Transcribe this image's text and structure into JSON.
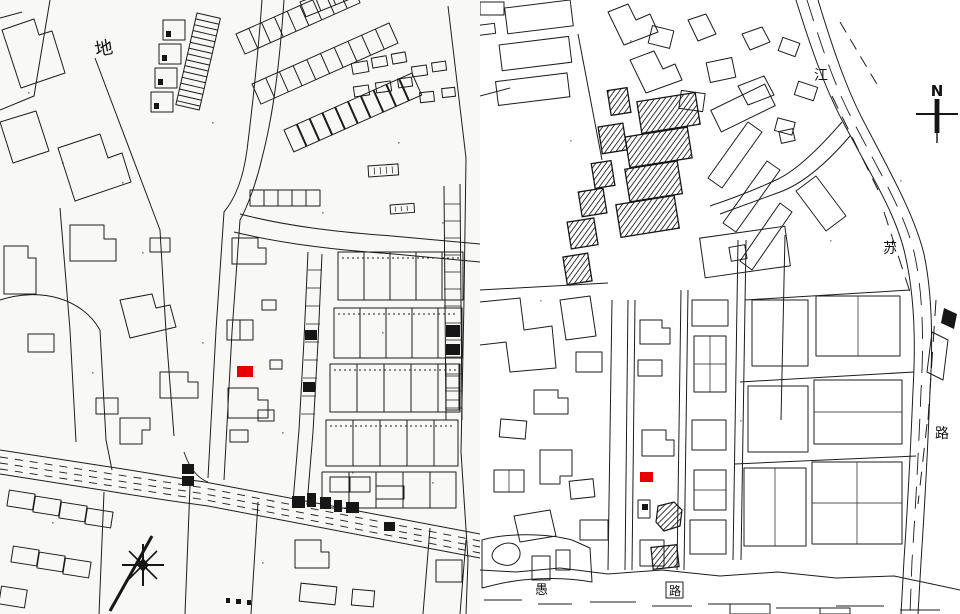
{
  "colors": {
    "marker_red": "#e60000",
    "ink": "#1c1c1c",
    "paper_left": "#f8f8f5",
    "paper_right": "#ffffff"
  },
  "left_map": {
    "district_label": "地"
  },
  "right_map": {
    "north_label": "N",
    "jiangsu_road_chars": [
      "江",
      "苏",
      "路"
    ],
    "yuyuan_road_chars": [
      "愚",
      "路"
    ]
  }
}
